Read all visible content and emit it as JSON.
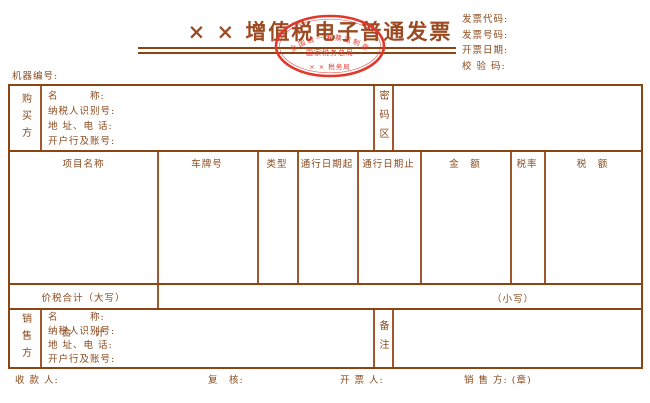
{
  "colors": {
    "text_brown": "#8a4a1e",
    "border_dark": "#8b4513",
    "border_light": "#a0572e",
    "stamp_red": "#e2372b"
  },
  "title": "× × 增值税电子普通发票",
  "stamp": {
    "arc_text": "全国统一发票监制章",
    "middle_text": "国家税务总局",
    "bottom_text": "× × 税务局"
  },
  "header_fields": {
    "invoice_code": "发票代码:",
    "invoice_number": "发票号码:",
    "issue_date": "开票日期:",
    "check_code": "校 验 码:"
  },
  "machine_number_label": "机器编号:",
  "buyer": {
    "party_label": "购买方",
    "fields": [
      "名　　　称:",
      "纳税人识别号:",
      "地 址、电 话:",
      "开户行及账号:"
    ],
    "password_area_label": "密码区"
  },
  "items_table": {
    "headers": [
      "项目名称",
      "车牌号",
      "类型",
      "通行日期起",
      "通行日期止",
      "金　额",
      "税率",
      "税　额"
    ],
    "total_label": "合　　计"
  },
  "totals_row": {
    "label": "价税合计（大写）",
    "small_label": "（小写）"
  },
  "seller": {
    "party_label": "销售方",
    "fields": [
      "名　　　称:",
      "纳税人识别号:",
      "地 址、电 话:",
      "开户行及账号:"
    ],
    "remark_label": "备注"
  },
  "footer": {
    "payee_label": "收 款 人:",
    "reviewer_label": "复　核:",
    "drawer_label": "开 票 人:",
    "seller_seal_label": "销 售 方: (章)"
  }
}
